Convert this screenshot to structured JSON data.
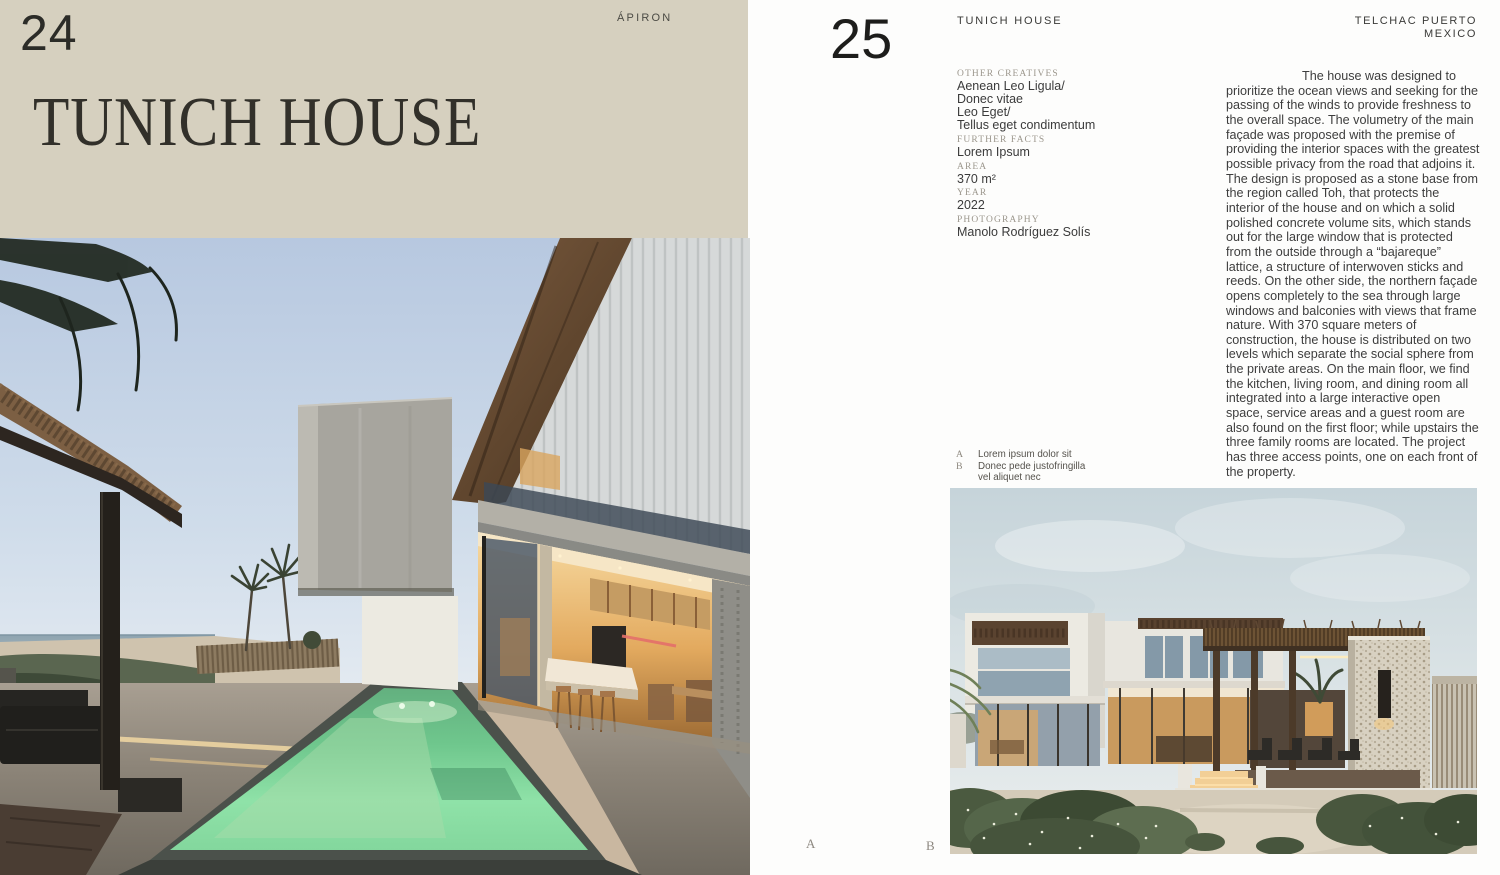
{
  "spread": {
    "left": {
      "page_number": "24",
      "brand": "ÁPIRON",
      "title": "TUNICH HOUSE"
    },
    "right": {
      "page_number": "25",
      "header_title": "TUNICH HOUSE",
      "location": {
        "line1": "TELCHAC PUERTO",
        "line2": "MEXICO"
      },
      "credits": [
        {
          "label": "OTHER CREATIVES",
          "lines": [
            "Aenean Leo Ligula/",
            "Donec vitae",
            "Leo Eget/",
            "Tellus eget condimentum"
          ]
        },
        {
          "label": "FURTHER FACTS",
          "lines": [
            "Lorem Ipsum"
          ]
        },
        {
          "label": "AREA",
          "lines": [
            "370 m²"
          ]
        },
        {
          "label": "YEAR",
          "lines": [
            "2022"
          ]
        },
        {
          "label": "PHOTOGRAPHY",
          "lines": [
            "Manolo Rodríguez Solís"
          ]
        }
      ],
      "body": "The house was designed to prioritize the ocean views and seeking for the passing of the winds to provide freshness to the overall space. The volumetry of the main façade was proposed with the premise of providing the interior spaces with the greatest possible privacy from the road that adjoins it. The design is proposed as a stone base from the region called Toh, that protects the interior of the house and on which a solid polished concrete volume sits, which stands out for the large window that is protected from the outside through a “bajareque” lattice, a structure of interwoven sticks and reeds. On the other side, the northern façade opens completely to the sea through large windows and balconies with views that frame nature. With 370 square meters of construction, the house is distributed on two levels which separate the social sphere from the private areas. On the main floor, we find the kitchen, living room, and dining room all integrated into a large interactive open space, service areas and a guest room are also found on the first floor; while upstairs the three family rooms are located. The project has three access points, one on each front of the property.",
      "captions": [
        {
          "key": "A",
          "lines": [
            "Lorem ipsum dolor sit"
          ]
        },
        {
          "key": "B",
          "lines": [
            "Donec pede justofringilla",
            "vel aliquet nec"
          ]
        }
      ],
      "photo_marks": {
        "a": "A",
        "b": "B"
      }
    },
    "colors": {
      "left_header_bg": "#d6d0bf",
      "ink": "#2f2d28",
      "muted_label": "#9c978d",
      "pool_green": "#7fd49b"
    }
  }
}
